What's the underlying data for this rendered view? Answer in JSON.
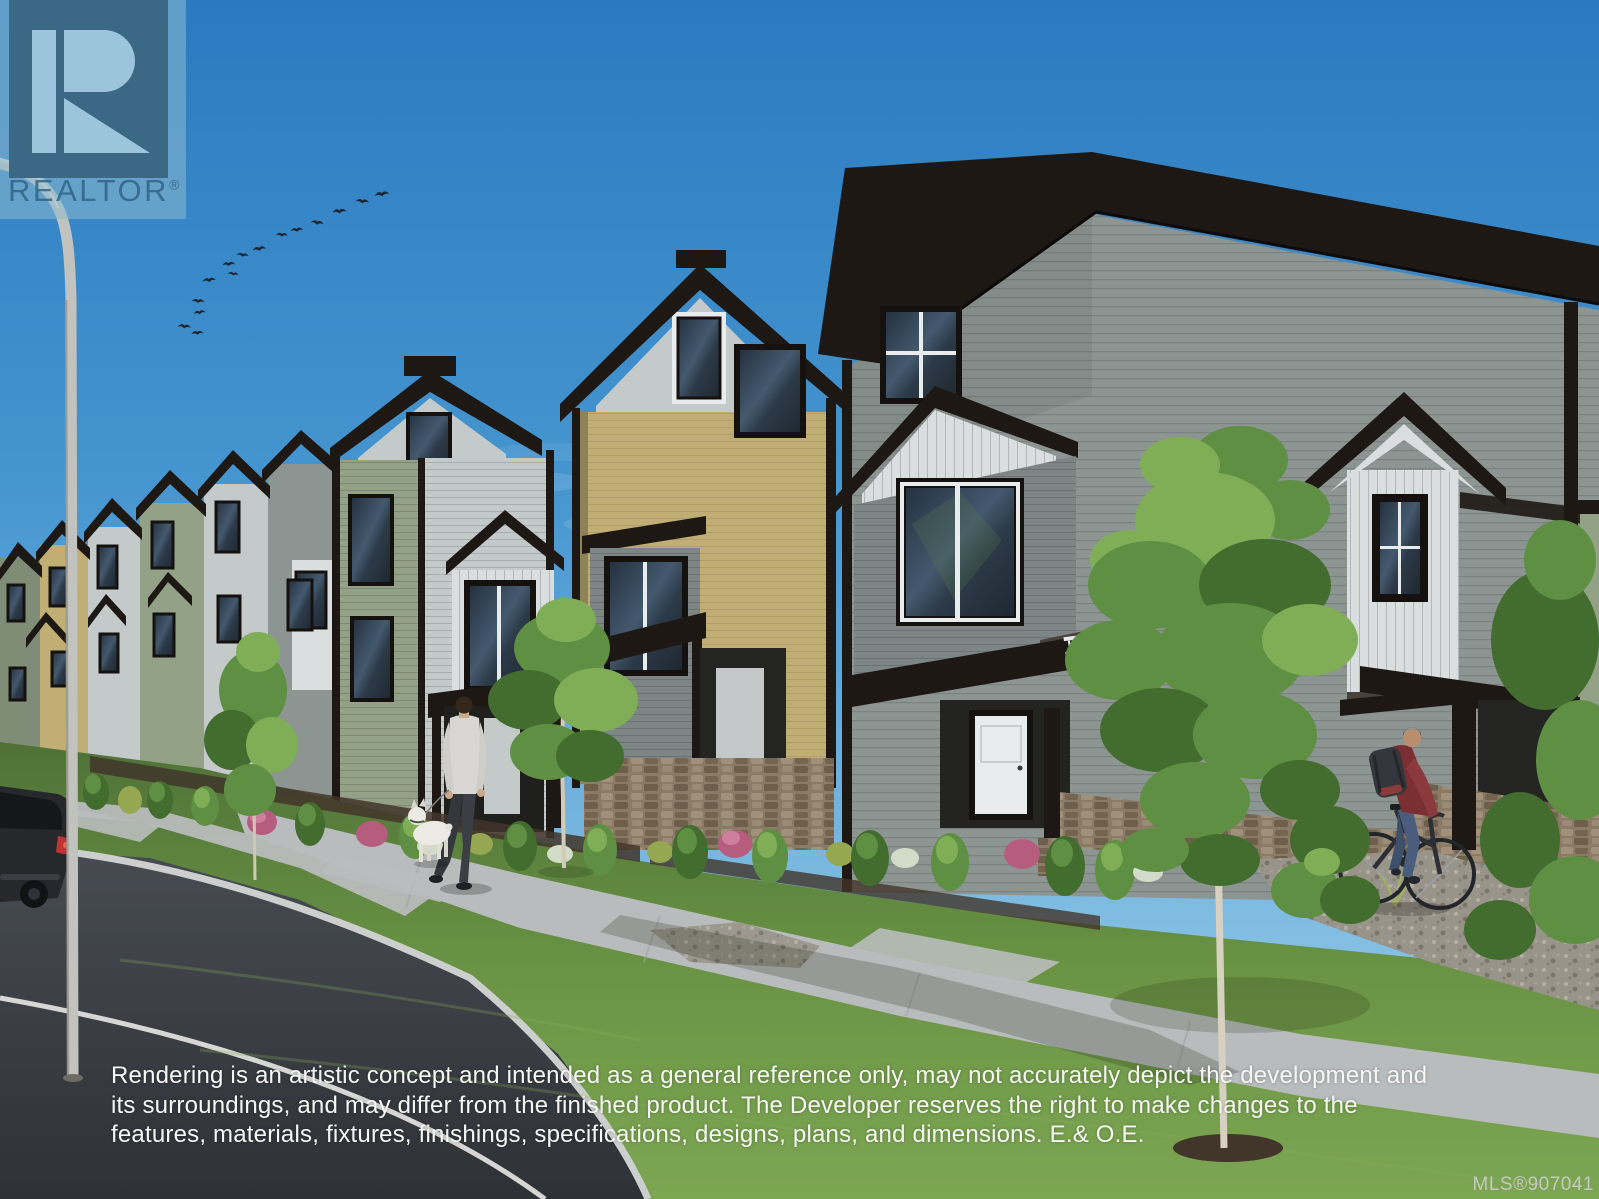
{
  "watermark": {
    "brand": "REALTOR",
    "registered_mark": "®"
  },
  "disclaimer": {
    "line1": "Rendering is an artistic concept and intended as a general reference only, may not accurately depict the development and",
    "line2": "its surroundings, and may differ from the finished product. The Developer reserves the right to make changes to the",
    "line3": "features, materials, fixtures, finishings, specifications, designs, plans, and dimensions. E.& O.E."
  },
  "listing": {
    "mls": "MLS®907041"
  },
  "scene": {
    "birds": 15,
    "people": 2,
    "dogs": 1,
    "bicycles": 1,
    "parked_cars": 1
  },
  "palette": {
    "sky_top": "#2b7ac0",
    "sky_mid": "#4595d0",
    "sky_low": "#a5d2ec",
    "roof": "#1d1814",
    "shingle": "#342c25",
    "siding_gray": "#8d9593",
    "siding_gray_dark": "#7d8685",
    "siding_light": "#c4c9c9",
    "siding_white": "#dadedf",
    "siding_tan": "#c0ae74",
    "siding_tan_dark": "#8f8259",
    "siding_sage": "#93a187",
    "siding_sage_dark": "#7f8d77",
    "frame_dark": "#14110f",
    "sash_white": "#e9ecec",
    "glass_dark": "#26313d",
    "glass_light": "#4d6478",
    "stone": "#8b7b66",
    "grass_far": "#4f7137",
    "grass_near": "#7da653",
    "road": "#3e4248",
    "road_line": "#e8e8e4",
    "sidewalk": "#b9bcbc",
    "curb": "#cdcfce",
    "gravel": "#99948a",
    "soil": "#42352a",
    "tree_green": "#5f8f42",
    "tree_green_light": "#7fae57",
    "tree_green_dark": "#426d2e",
    "trunk": "#d8d1c1",
    "bird": "#1c2530",
    "shrub_pink": "#b65d7d",
    "shrub_white": "#d3dcc9",
    "shrub_yellow": "#95a851",
    "shirt_gray": "#d8d7d3",
    "pants_dark": "#3b3f45",
    "skin": "#c9a98c",
    "shirt_maroon": "#7c2f33",
    "jeans": "#4a5d7c",
    "backpack": "#33363a",
    "car_body": "#26282c",
    "car_light": "#c23434",
    "lamp": "#c2c3bf",
    "watermark_panel": "rgba(140,185,205,0.55)",
    "watermark_box": "#3b6885",
    "watermark_glyph": "#9cc4da",
    "watermark_text": "#2f6486",
    "disclaimer_text": "#f6f6f4",
    "mls_text": "#cccccb"
  }
}
